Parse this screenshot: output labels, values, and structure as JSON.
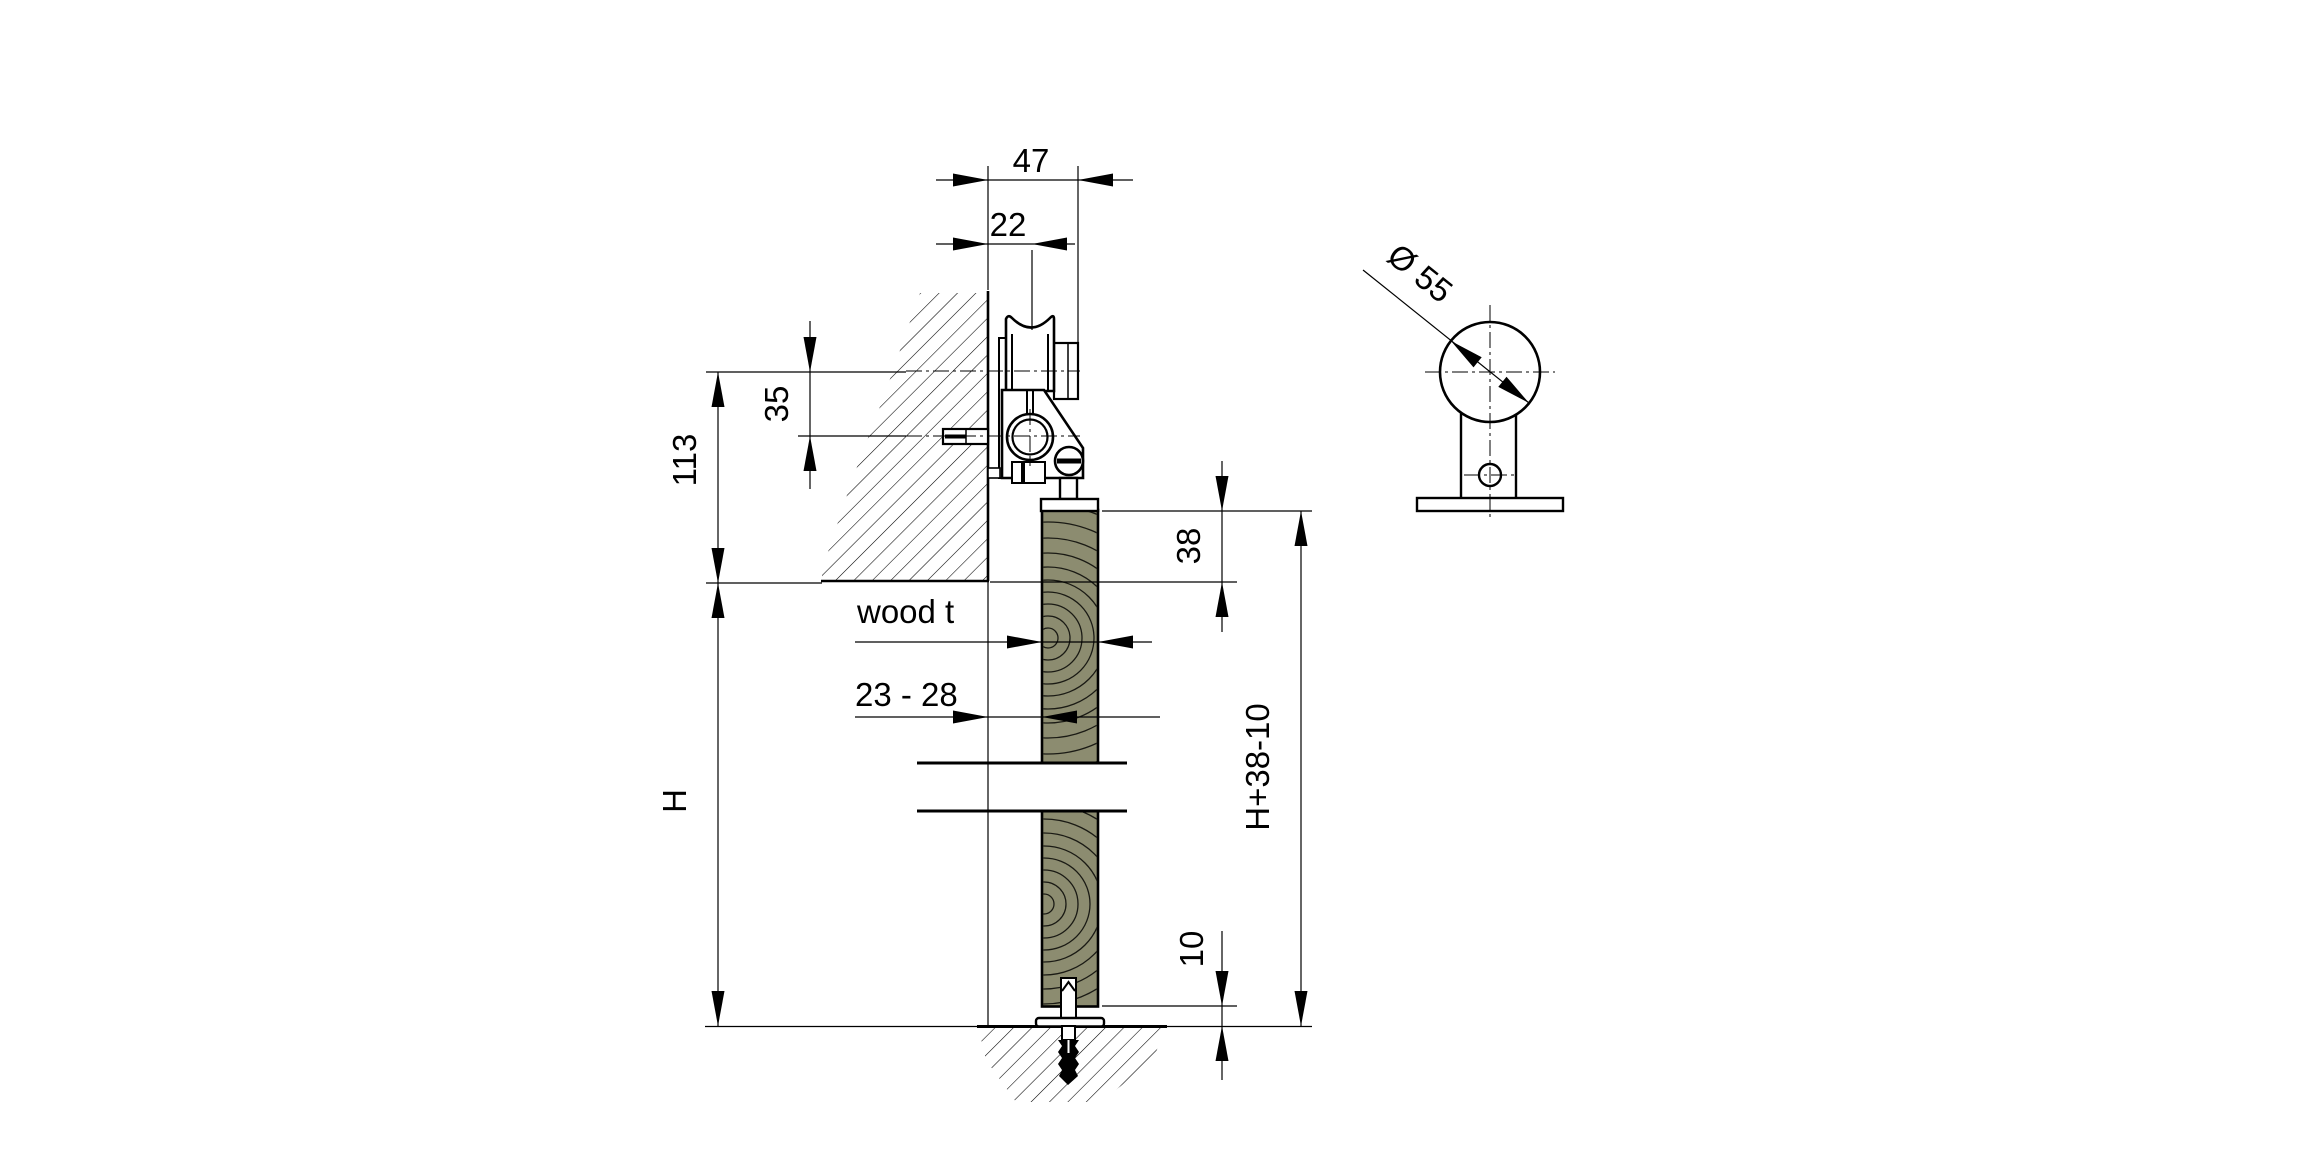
{
  "drawing": {
    "title": "sliding-door roller fitting installation drawing",
    "background": "#ffffff",
    "line_color": "#000000",
    "wood_color": "#8c8c70",
    "front_view": {
      "dim_top_width": "47",
      "dim_roller_offset": "22",
      "dim_axis_to_screw": "35",
      "dim_bracket_height": "113",
      "dim_door_height": "H",
      "label_wood_thickness": "wood t",
      "dim_wood_thickness_range": "23 - 28",
      "dim_top_overlap": "38",
      "dim_total_height": "H+38-10",
      "dim_floor_gap": "10"
    },
    "side_view": {
      "dim_roller_diameter": "Ø 55"
    }
  }
}
